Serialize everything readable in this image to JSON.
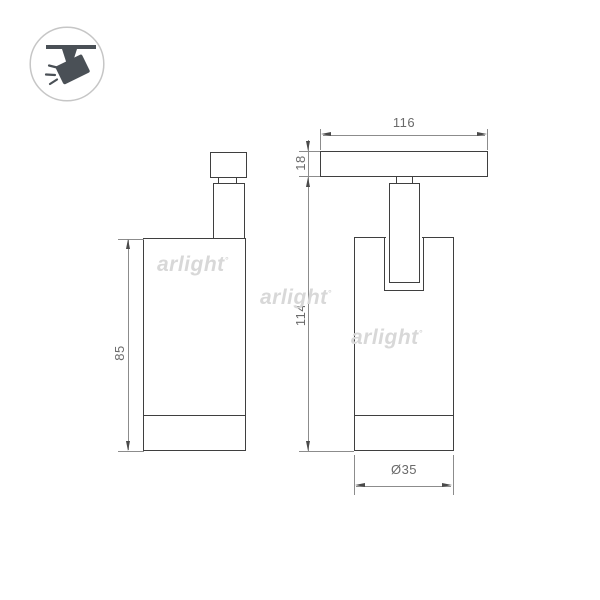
{
  "watermark": {
    "text": "arlight",
    "superscript": "°"
  },
  "dimensions": {
    "track_length": "116",
    "track_height": "18",
    "overall_height": "114",
    "body_height": "85",
    "body_diameter": "Ø35"
  },
  "icons": {
    "badge": "ceiling-track-spotlight-icon"
  },
  "colors": {
    "outline": "#3f3f3f",
    "dim_line": "#8c8c8c",
    "dim_text": "#6a6a6a",
    "arrowhead": "#4a4a4a",
    "watermark": "#d8d8d8",
    "icon_glyph": "#4a5056",
    "icon_circle": "#c6c6c6",
    "bg": "#ffffff"
  }
}
